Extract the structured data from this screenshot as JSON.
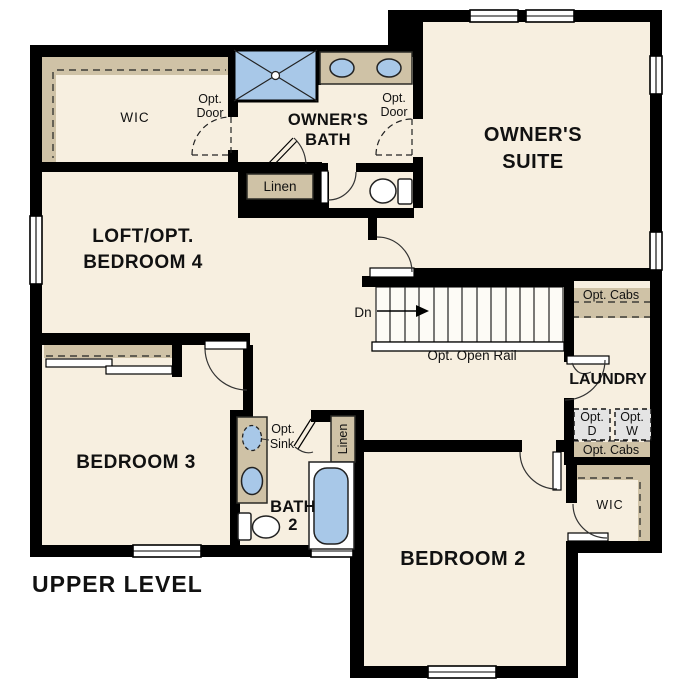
{
  "title": "UPPER LEVEL",
  "rooms": {
    "wic_upper": "WIC",
    "owners_bath_l1": "OWNER'S",
    "owners_bath_l2": "BATH",
    "owners_suite_l1": "OWNER'S",
    "owners_suite_l2": "SUITE",
    "loft_l1": "LOFT/OPT.",
    "loft_l2": "BEDROOM 4",
    "bedroom3": "BEDROOM 3",
    "bath2_l1": "BATH",
    "bath2_l2": "2",
    "bedroom2": "BEDROOM 2",
    "laundry": "LAUNDRY",
    "wic_lower": "WIC"
  },
  "annotations": {
    "opt": "Opt.",
    "door": "Door",
    "linen": "Linen",
    "dn": "Dn",
    "opt_open_rail": "Opt. Open Rail",
    "opt_cabs": "Opt. Cabs",
    "dryer": "D",
    "washer": "W",
    "sink": "Sink"
  },
  "colors": {
    "floor": "#f7efe0",
    "wall": "#000000",
    "cabinet_tan": "#cfc2a6",
    "fixture_blue": "#a8c8e8",
    "appliance_gray": "#e4e4e4"
  }
}
